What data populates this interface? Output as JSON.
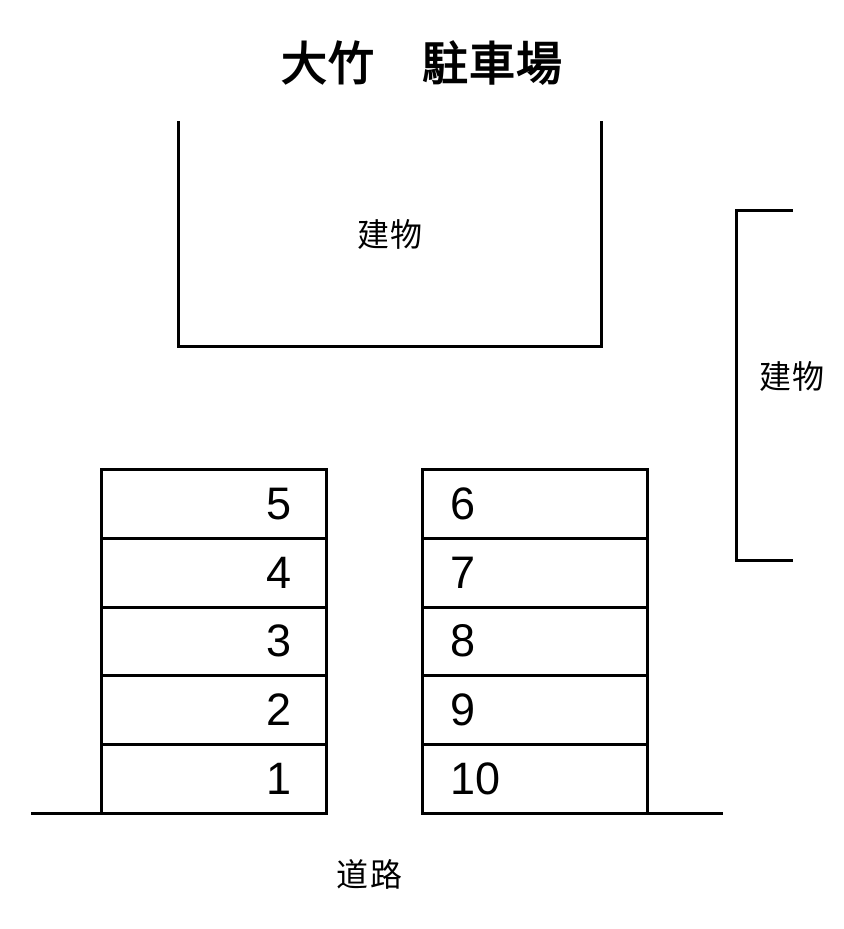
{
  "title": "大竹　駐車場",
  "buildings": {
    "top": {
      "label": "建物"
    },
    "right": {
      "label": "建物"
    }
  },
  "parking": {
    "left_column": {
      "spaces": [
        "5",
        "4",
        "3",
        "2",
        "1"
      ]
    },
    "right_column": {
      "spaces": [
        "6",
        "7",
        "8",
        "9",
        "10"
      ]
    }
  },
  "road": {
    "label": "道路"
  },
  "colors": {
    "line": "#000000",
    "background": "#ffffff",
    "text": "#000000"
  }
}
